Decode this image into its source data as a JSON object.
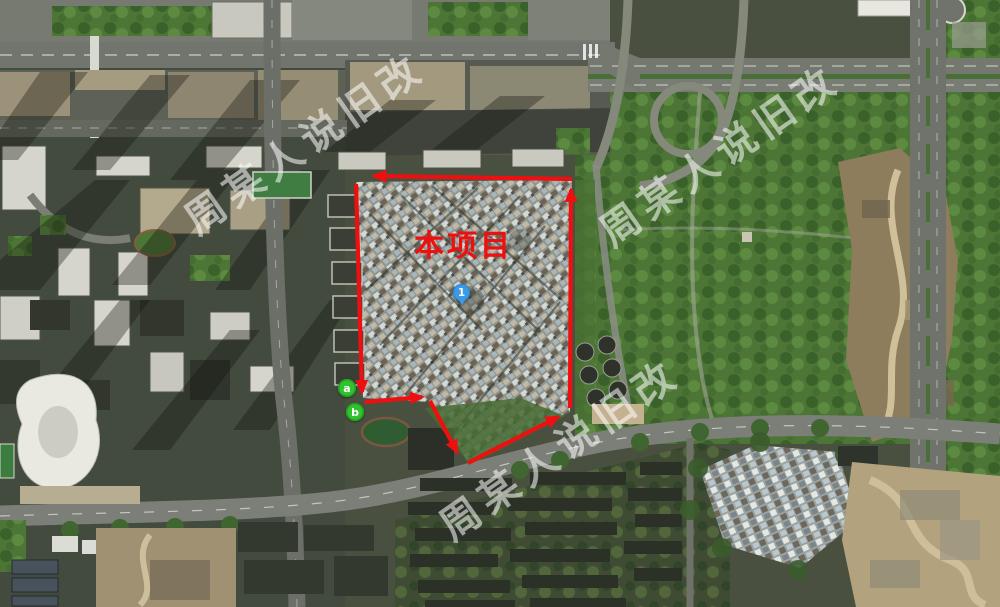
{
  "annotations": {
    "project_label": {
      "text": "本项目",
      "color": "#ee1010"
    },
    "boundary": {
      "color": "#ee1010",
      "style": "arrow-segments"
    },
    "markers": {
      "info": {
        "label": "1",
        "color": "#3a9ae8"
      },
      "a": {
        "label": "a",
        "color": "#2fc42f"
      },
      "b": {
        "label": "b",
        "color": "#2fc42f"
      }
    },
    "watermarks": {
      "text": "周某人说旧改",
      "color": "#ffffff",
      "opacity": 0.55,
      "count": 3
    }
  }
}
